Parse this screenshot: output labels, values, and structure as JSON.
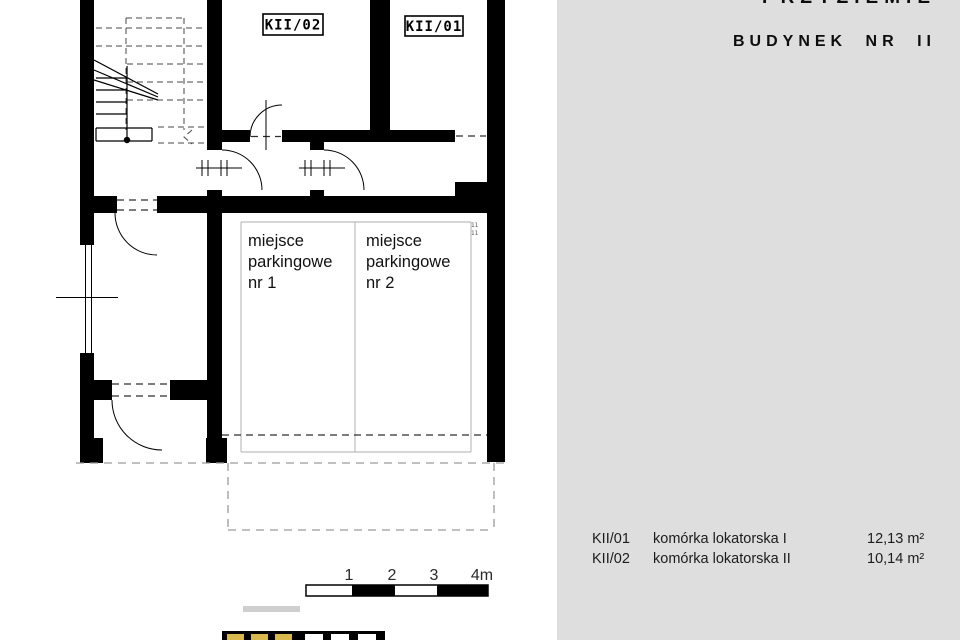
{
  "header": {
    "floor_title": "PRZYZIEMIE",
    "building_title": "BUDYNEK NR II"
  },
  "plan": {
    "rooms": [
      {
        "label": "KII/02"
      },
      {
        "label": "KII/01"
      }
    ],
    "parking_spaces": [
      {
        "line1": "miejsce",
        "line2": "parkingowe",
        "line3": "nr 1"
      },
      {
        "line1": "miejsce",
        "line2": "parkingowe",
        "line3": "nr 2"
      }
    ],
    "wall_note": "11"
  },
  "scale_bar": {
    "ticks": [
      "1",
      "2",
      "3",
      "4m"
    ]
  },
  "legend": {
    "rows": [
      {
        "code": "KII/01",
        "name": "komórka lokatorska I",
        "area": "12,13 m²"
      },
      {
        "code": "KII/02",
        "name": "komórka lokatorska II",
        "area": "10,14 m²"
      }
    ]
  },
  "colors": {
    "panel_bg": "#dedede",
    "accent_yellow": "#d9b94e",
    "plan_line": "#000000"
  }
}
